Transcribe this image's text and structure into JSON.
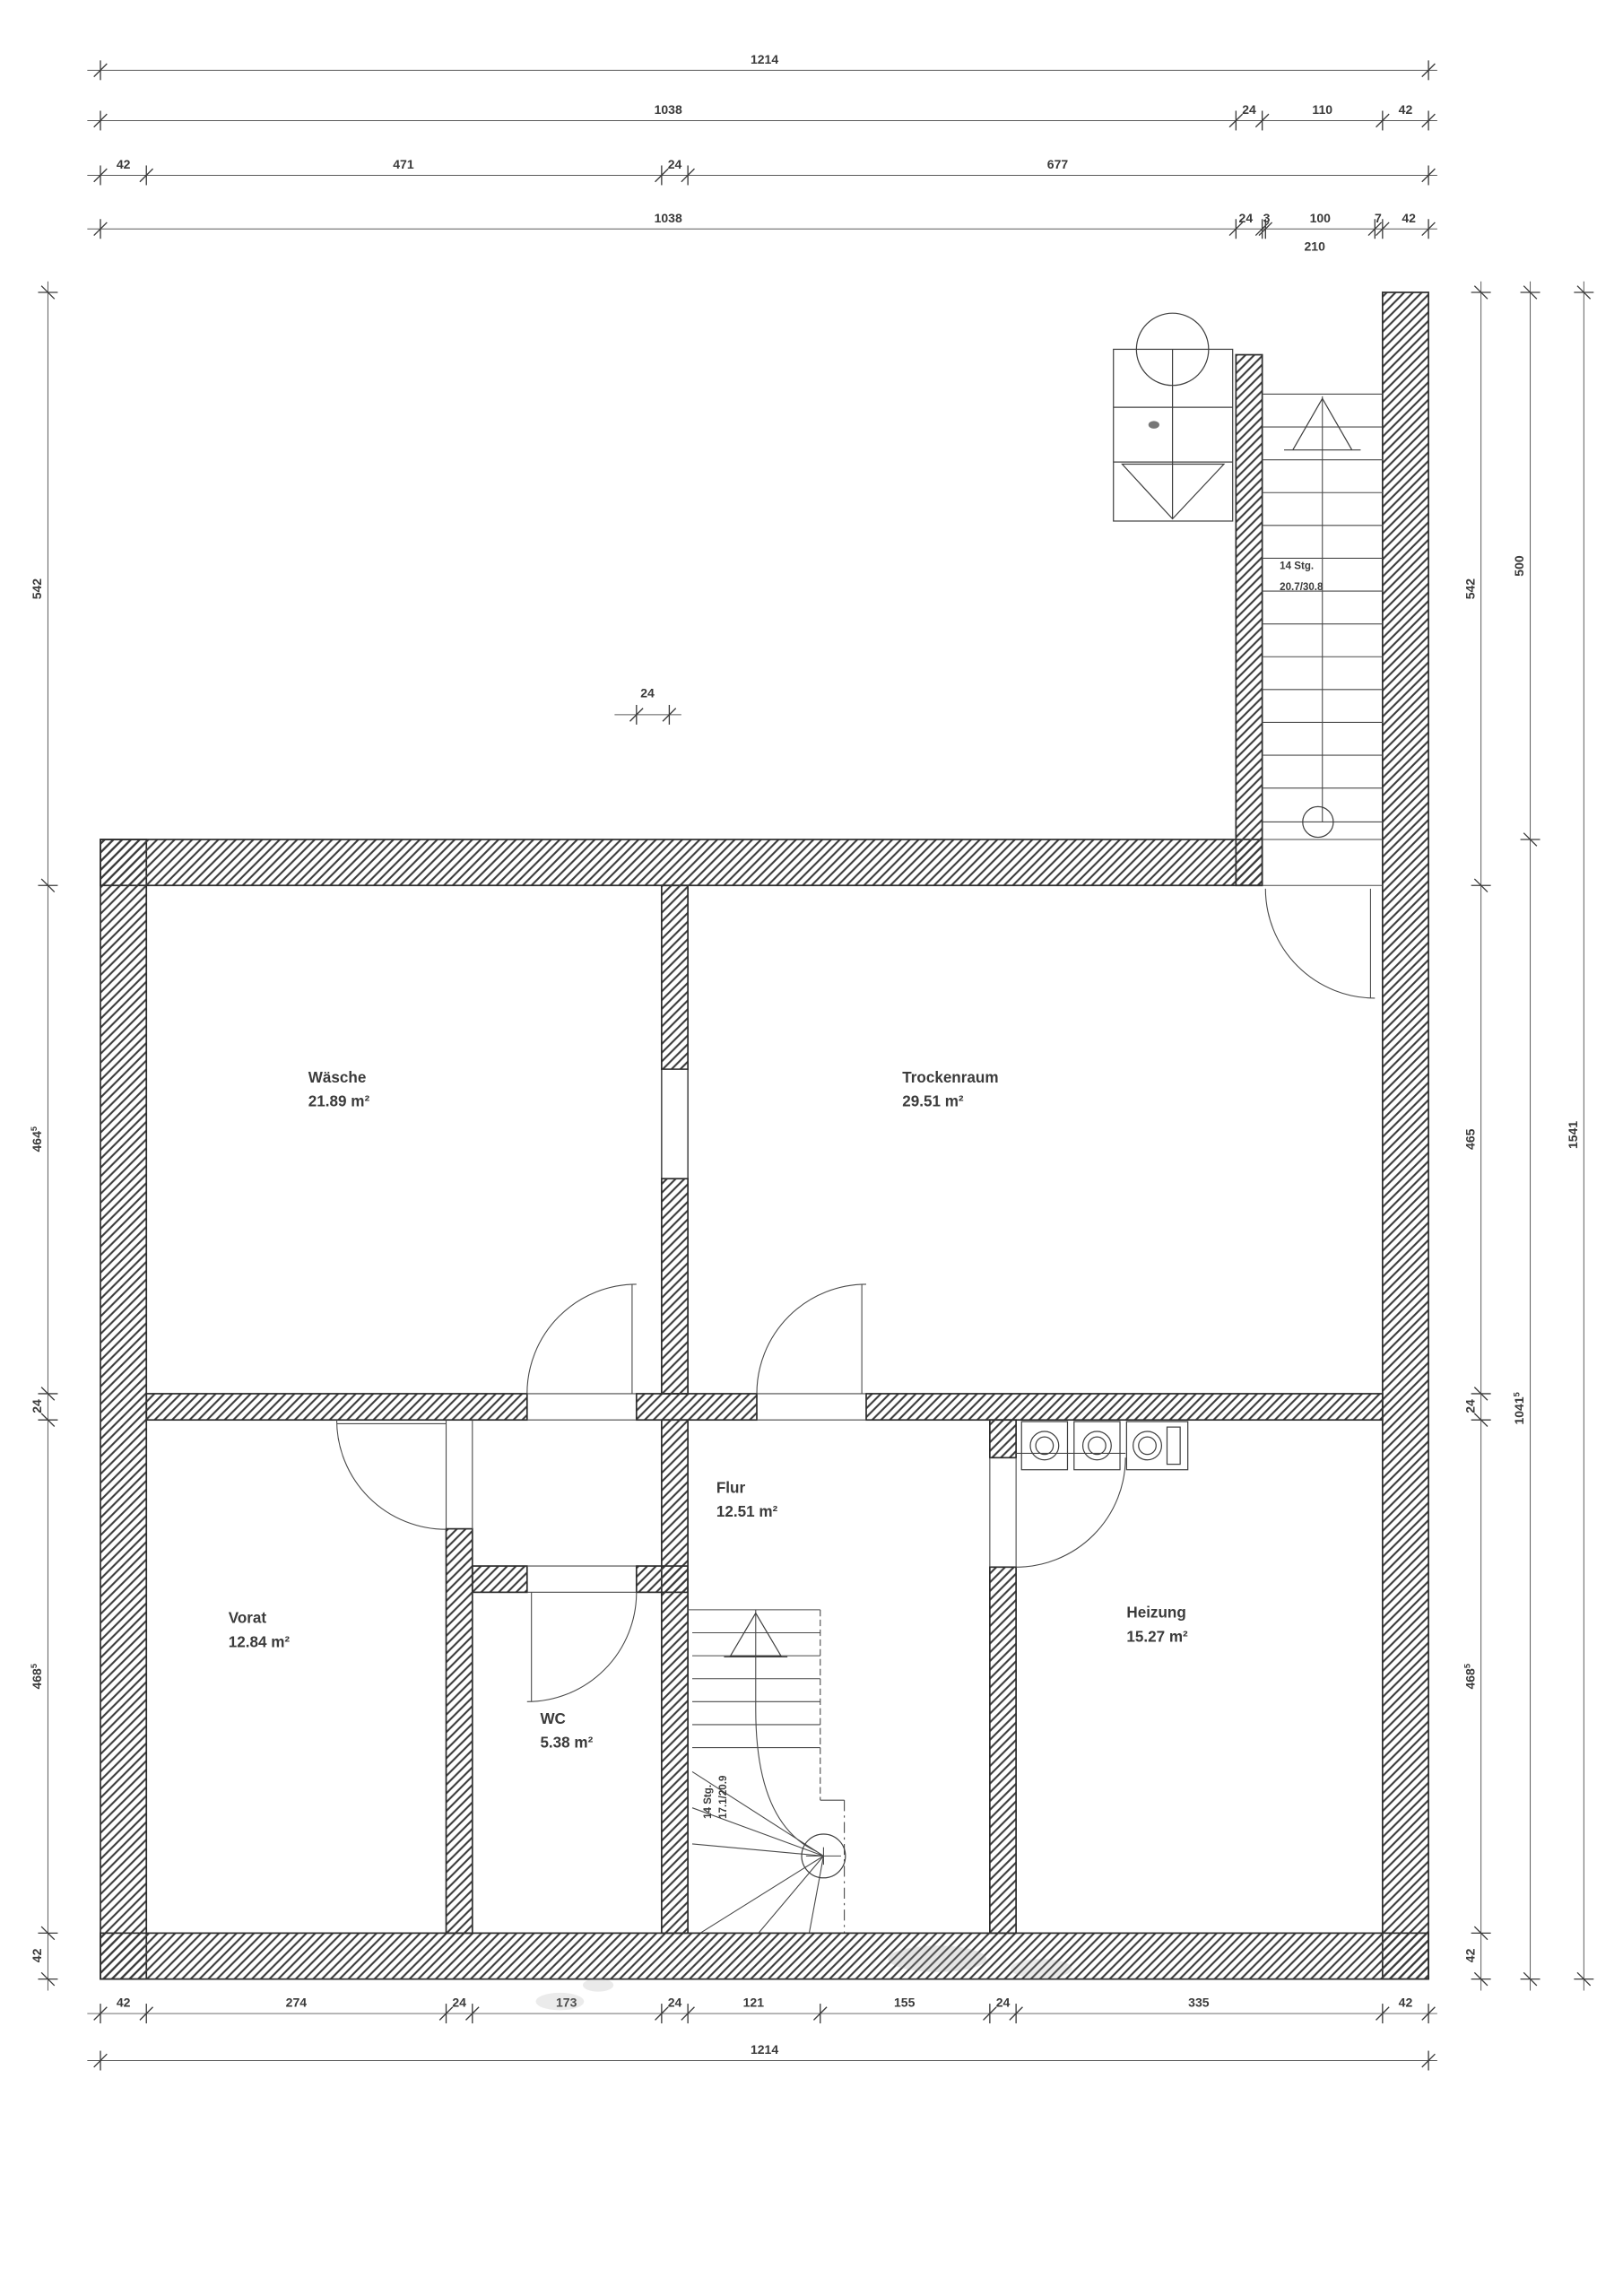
{
  "ink": "#2e2e2e",
  "rooms": [
    {
      "name": "Wäsche",
      "area": "21.89 m²"
    },
    {
      "name": "Trockenraum",
      "area": "29.51 m²"
    },
    {
      "name": "Vorat",
      "area": "12.84 m²"
    },
    {
      "name": "WC",
      "area": "5.38 m²"
    },
    {
      "name": "Flur",
      "area": "12.51 m²"
    },
    {
      "name": "Heizung",
      "area": "15.27 m²"
    }
  ],
  "stairs": {
    "exterior": {
      "line1": "14 Stg.",
      "line2": "20.7/30.8"
    },
    "interior": {
      "line1": "14 Stg.",
      "line2": "17.1/20.9"
    }
  },
  "dimensions": {
    "top_row1": {
      "total": "1214"
    },
    "top_row2": {
      "a": "1038",
      "b": "24",
      "c": "110",
      "d": "42"
    },
    "top_row3": {
      "a": "42",
      "b": "471",
      "c": "24",
      "d": "677"
    },
    "top_row4": {
      "a": "1038",
      "b": "24",
      "c": "3",
      "d": "100",
      "e": "7",
      "f": "42"
    },
    "top_row5": {
      "a": "210"
    },
    "left_col": {
      "a": "542",
      "b": "464",
      "b_sup": "5",
      "c": "24",
      "d": "468",
      "d_sup": "5",
      "e": "42"
    },
    "right_col1": {
      "a": "542",
      "b": "465",
      "c": "24",
      "d": "468",
      "d_sup": "5",
      "e": "42"
    },
    "right_col2": {
      "a": "500",
      "b": "1041",
      "b_sup": "5"
    },
    "right_col3": {
      "a": "1541"
    },
    "bottom_row1": {
      "a": "42",
      "b": "274",
      "c": "24",
      "d": "173",
      "e": "24",
      "f": "121",
      "g": "155",
      "h": "24",
      "i": "335",
      "j": "42"
    },
    "bottom_row2": {
      "total": "1214"
    },
    "wall_marker": {
      "label": "24"
    }
  }
}
